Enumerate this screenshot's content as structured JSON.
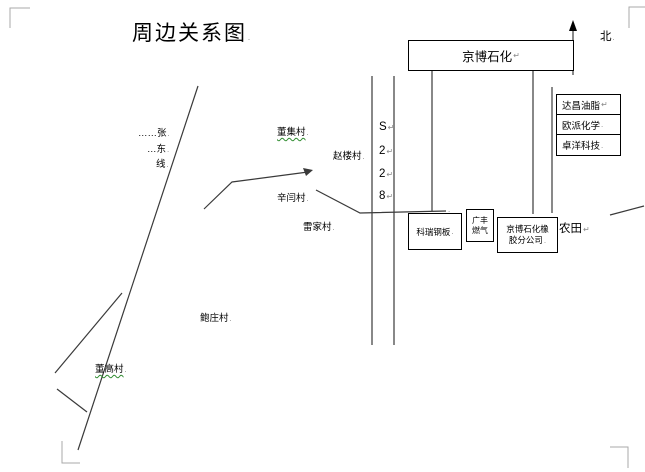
{
  "document": {
    "title": "周边关系图",
    "compass_label": "北",
    "marks": {
      "pilcrow": "↵",
      "period": "."
    }
  },
  "roads": {
    "s228_chars": [
      "S",
      "2",
      "2",
      "8"
    ],
    "zhangdong_lines": [
      "……张",
      "…东",
      "线"
    ]
  },
  "facilities": {
    "jingbo_petrochemical": "京博石化",
    "companies_east": [
      "达昌油脂",
      "欧派化学",
      "卓洋科技"
    ],
    "kerui_steel": "科瑞钢板",
    "gas_station_lines": [
      "广丰",
      "燃气"
    ],
    "rubber_branch_lines": [
      "京博石化橡",
      "胶分公司"
    ],
    "farmland": "农田"
  },
  "villages": [
    {
      "name": "董集村"
    },
    {
      "name": "赵楼村"
    },
    {
      "name": "辛闫村"
    },
    {
      "name": "雷家村"
    },
    {
      "name": "鲍庄村"
    },
    {
      "name": "董高村"
    }
  ],
  "colors": {
    "ink": "#000000",
    "line": "#3a3a3a",
    "hidden_char_gray": "#8a8a8a",
    "spellcheck_green": "#2e8b2e"
  }
}
